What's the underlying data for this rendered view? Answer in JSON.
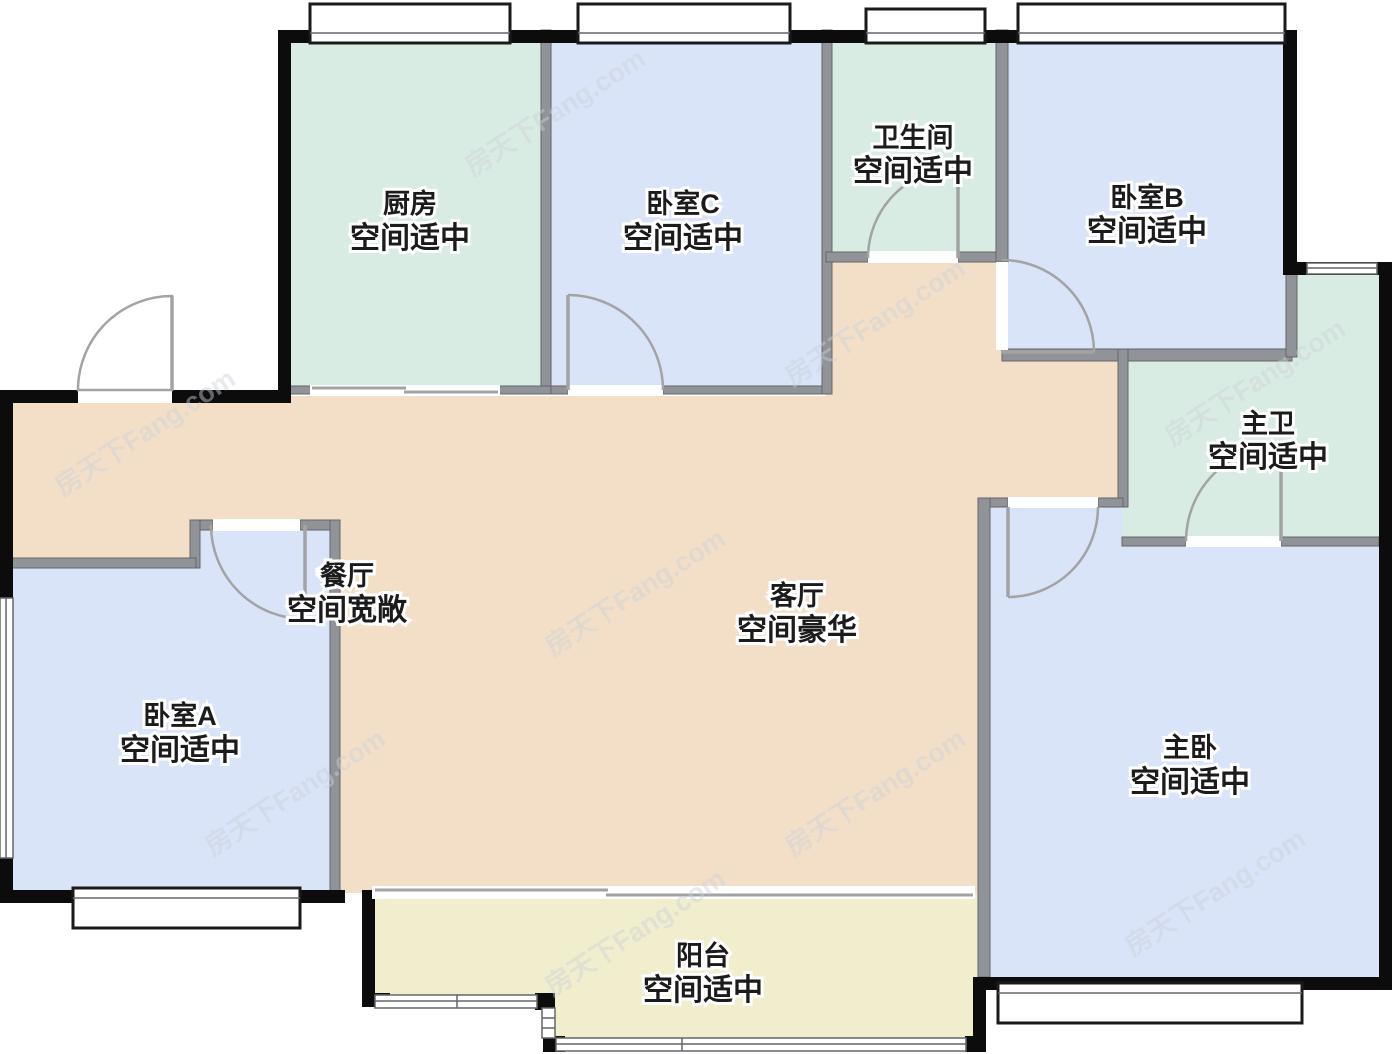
{
  "watermark": {
    "text": "房天下Fang.com"
  },
  "palette": {
    "wall_exterior": "#0c0c0c",
    "wall_interior": "#909398",
    "wall_interior_edge": "#64666a",
    "window_frame": "#1a1a1a",
    "door_stroke": "#a3a3a3",
    "label_text": "#1b1b1b",
    "label_halo": "#ffffff",
    "watermark": "#ccd2da",
    "background": "#ffffff"
  },
  "rooms": {
    "kitchen": {
      "name": "厨房",
      "grade": "空间适中",
      "color": "#d9ece3"
    },
    "bedroom_c": {
      "name": "卧室C",
      "grade": "空间适中",
      "color": "#d9e4f8"
    },
    "bathroom": {
      "name": "卫生间",
      "grade": "空间适中",
      "color": "#d9ece3"
    },
    "bedroom_b": {
      "name": "卧室B",
      "grade": "空间适中",
      "color": "#d9e4f8"
    },
    "master_bath": {
      "name": "主卫",
      "grade": "空间适中",
      "color": "#d9ece3"
    },
    "dining": {
      "name": "餐厅",
      "grade": "空间宽敞"
    },
    "living": {
      "name": "客厅",
      "grade": "空间豪华",
      "color": "#f3dfc7"
    },
    "bedroom_a": {
      "name": "卧室A",
      "grade": "空间适中",
      "color": "#d9e4f8"
    },
    "master_bedroom": {
      "name": "主卧",
      "grade": "空间适中",
      "color": "#d9e4f8"
    },
    "balcony": {
      "name": "阳台",
      "grade": "空间适中",
      "color": "#f1eecd"
    }
  }
}
